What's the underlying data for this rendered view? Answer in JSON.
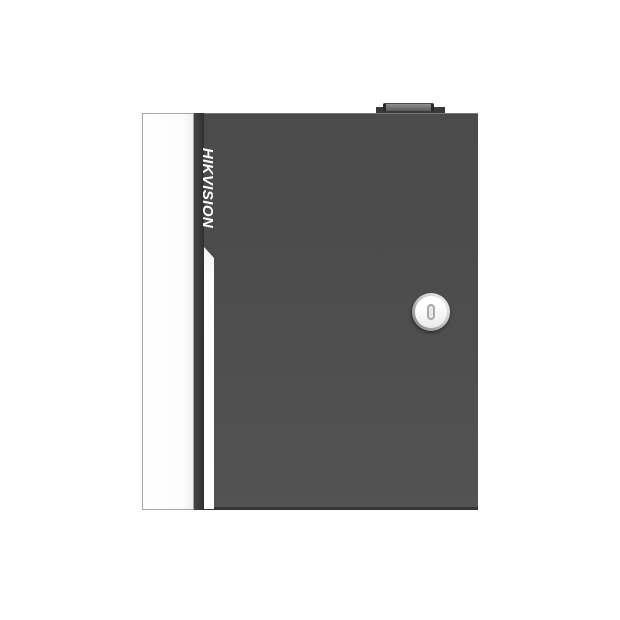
{
  "product": {
    "brand_label": "HIKVISION"
  },
  "icons": {
    "keyhole": "keyhole-icon (vertical capsule slot rendered as CSS rounded rectangle)"
  },
  "colors": {
    "page_background": "#ffffff",
    "door_face": "#4d4d4d",
    "door_face_light": "#535353",
    "side_panel": "#fcfcfc",
    "side_panel_border": "#a5a5a5",
    "groove_dark": "#383838",
    "accent_stripe": "#fdfdfd",
    "brand_text": "#ffffff",
    "top_tab_base": "#3a3a3a",
    "top_tab_cap": "#8f8f8f",
    "lock_ring_light": "#e3e3e3",
    "lock_ring_dark": "#868686",
    "lock_disc": "#ffffff",
    "keyhole_outline": "#a9a9a9",
    "keyhole_fill": "#e9e9e9",
    "bottom_lip": "#bfbfbf",
    "door_top_highlight": "#777777",
    "door_bottom_edge": "#353535"
  }
}
